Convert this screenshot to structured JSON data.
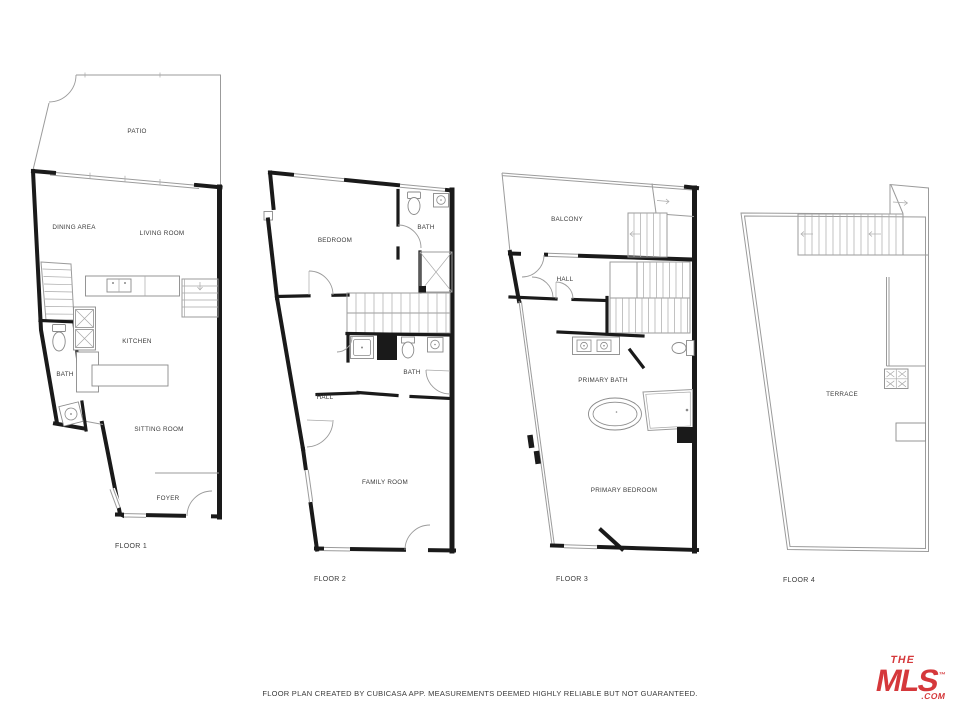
{
  "floors": {
    "floor1": {
      "label": "FLOOR 1",
      "rooms": {
        "patio": "PATIO",
        "dining": "DINING AREA",
        "living": "LIVING ROOM",
        "kitchen": "KITCHEN",
        "bath": "BATH",
        "sitting": "SITTING ROOM",
        "foyer": "FOYER"
      }
    },
    "floor2": {
      "label": "FLOOR 2",
      "rooms": {
        "bedroom": "BEDROOM",
        "bath_upper": "BATH",
        "hall": "HALL",
        "bath_mid": "BATH",
        "family": "FAMILY ROOM"
      }
    },
    "floor3": {
      "label": "FLOOR 3",
      "rooms": {
        "balcony": "BALCONY",
        "hall": "HALL",
        "primary_bath": "PRIMARY BATH",
        "primary_bedroom": "PRIMARY BEDROOM"
      }
    },
    "floor4": {
      "label": "FLOOR 4",
      "rooms": {
        "terrace": "TERRACE"
      }
    }
  },
  "footer": {
    "disclaimer": "FLOOR PLAN CREATED BY CUBICASA APP. MEASUREMENTS DEEMED HIGHLY RELIABLE BUT NOT GUARANTEED."
  },
  "logo": {
    "the": "THE",
    "name": "MLS",
    "tm": "™",
    "domain": ".COM",
    "color": "#d5383b"
  },
  "colors": {
    "wall": "#1a1a1a",
    "thin_line": "#9b9b9b",
    "background": "#ffffff",
    "label": "#3a3a3a"
  }
}
